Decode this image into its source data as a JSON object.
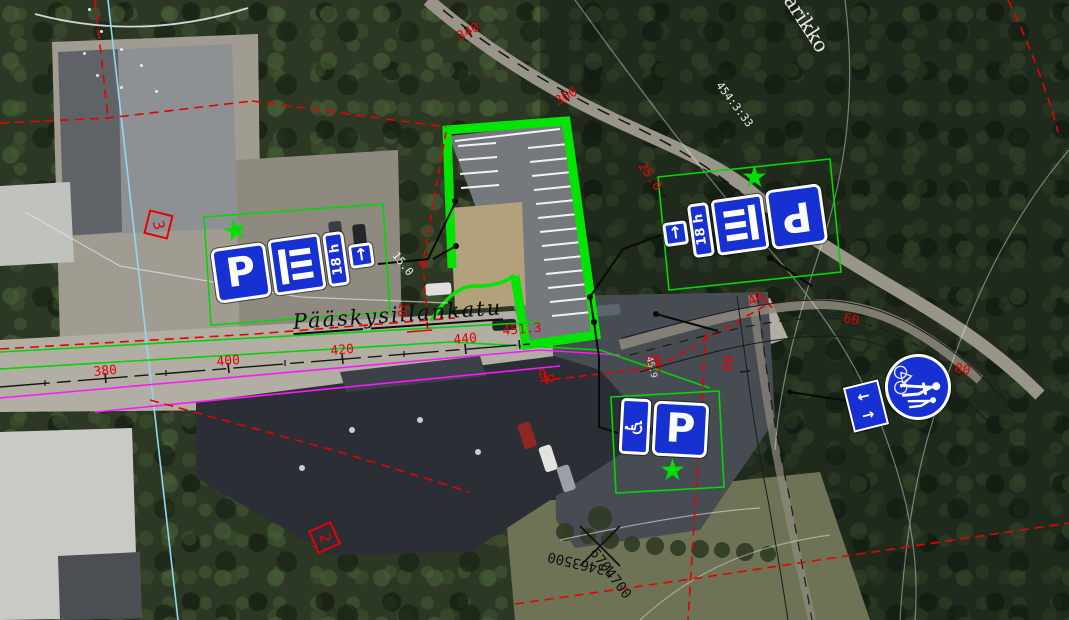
{
  "map": {
    "street": {
      "name": "Pääskysillankatu"
    },
    "labels": {
      "area_name": "arikko",
      "parcel_id": "454:3:33",
      "grid_northing": "6704700",
      "grid_easting": "23463500",
      "plot_number_a": "3",
      "plot_number_b": "2"
    },
    "stations": {
      "street": [
        "380",
        "400",
        "420",
        "440",
        "451.3"
      ],
      "path_top": [
        "340",
        "360"
      ],
      "path_right": [
        "0",
        "20",
        "40",
        "60",
        "80"
      ],
      "path_branch": [
        "60"
      ]
    },
    "dims": {
      "a": "15.0",
      "b": "10",
      "c": "25.0",
      "spot_height": "45.9"
    },
    "signs": {
      "parking_letter": "P",
      "time_limit": "18 h",
      "arrow_up": "↑",
      "arrow_left": "←",
      "arrow_right": "→",
      "wheelchair_glyph": "♿",
      "star_glyph": "★"
    },
    "colors": {
      "overlay_green": "#00D800",
      "overlay_red": "#E60000",
      "magenta": "#FF17FF",
      "cyan": "#8FD8EF",
      "sign_blue": "#1730D2",
      "star_green": "#00DD00"
    }
  }
}
